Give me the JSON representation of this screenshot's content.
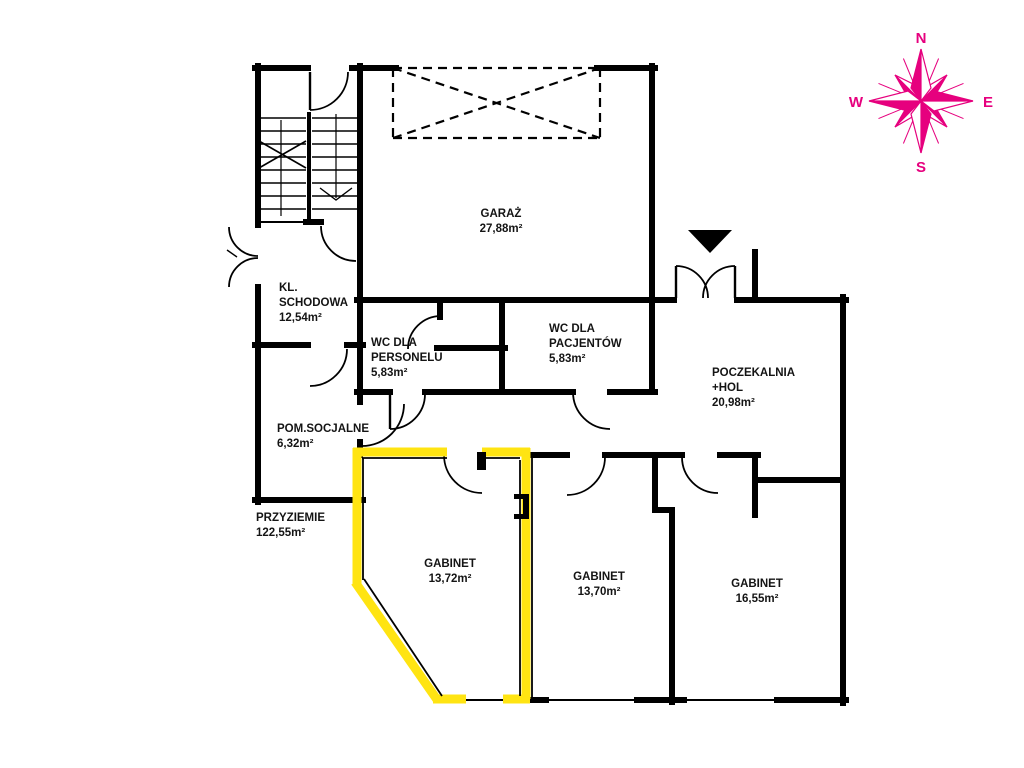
{
  "plan": {
    "type": "floor-plan",
    "floor_label": "PRZYZIEMIE",
    "floor_area": "122,55m²",
    "highlight_color": "#ffe412",
    "wall_color": "#000000",
    "compass_color": "#e6007e"
  },
  "rooms": [
    {
      "id": "garaz",
      "lines": [
        "GARAŻ",
        "27,88m²"
      ]
    },
    {
      "id": "kl-schodowa",
      "lines": [
        "KL.",
        "SCHODOWA",
        "12,54m²"
      ]
    },
    {
      "id": "wc-personelu",
      "lines": [
        "WC DLA",
        "PERSONELU",
        "5,83m²"
      ]
    },
    {
      "id": "wc-pacjentow",
      "lines": [
        "WC DLA",
        "PACJENTÓW",
        "5,83m²"
      ]
    },
    {
      "id": "poczekalnia",
      "lines": [
        "POCZEKALNIA",
        "+HOL",
        "20,98m²"
      ]
    },
    {
      "id": "pom-socjalne",
      "lines": [
        "POM.SOCJALNE",
        "6,32m²"
      ]
    },
    {
      "id": "przyziemie",
      "lines": [
        "PRZYZIEMIE",
        "122,55m²"
      ]
    },
    {
      "id": "gabinet-1",
      "lines": [
        "GABINET",
        "13,72m²"
      ],
      "highlighted": true
    },
    {
      "id": "gabinet-2",
      "lines": [
        "GABINET",
        "13,70m²"
      ]
    },
    {
      "id": "gabinet-3",
      "lines": [
        "GABINET",
        "16,55m²"
      ]
    }
  ],
  "compass": {
    "n": "N",
    "e": "E",
    "s": "S",
    "w": "W"
  }
}
